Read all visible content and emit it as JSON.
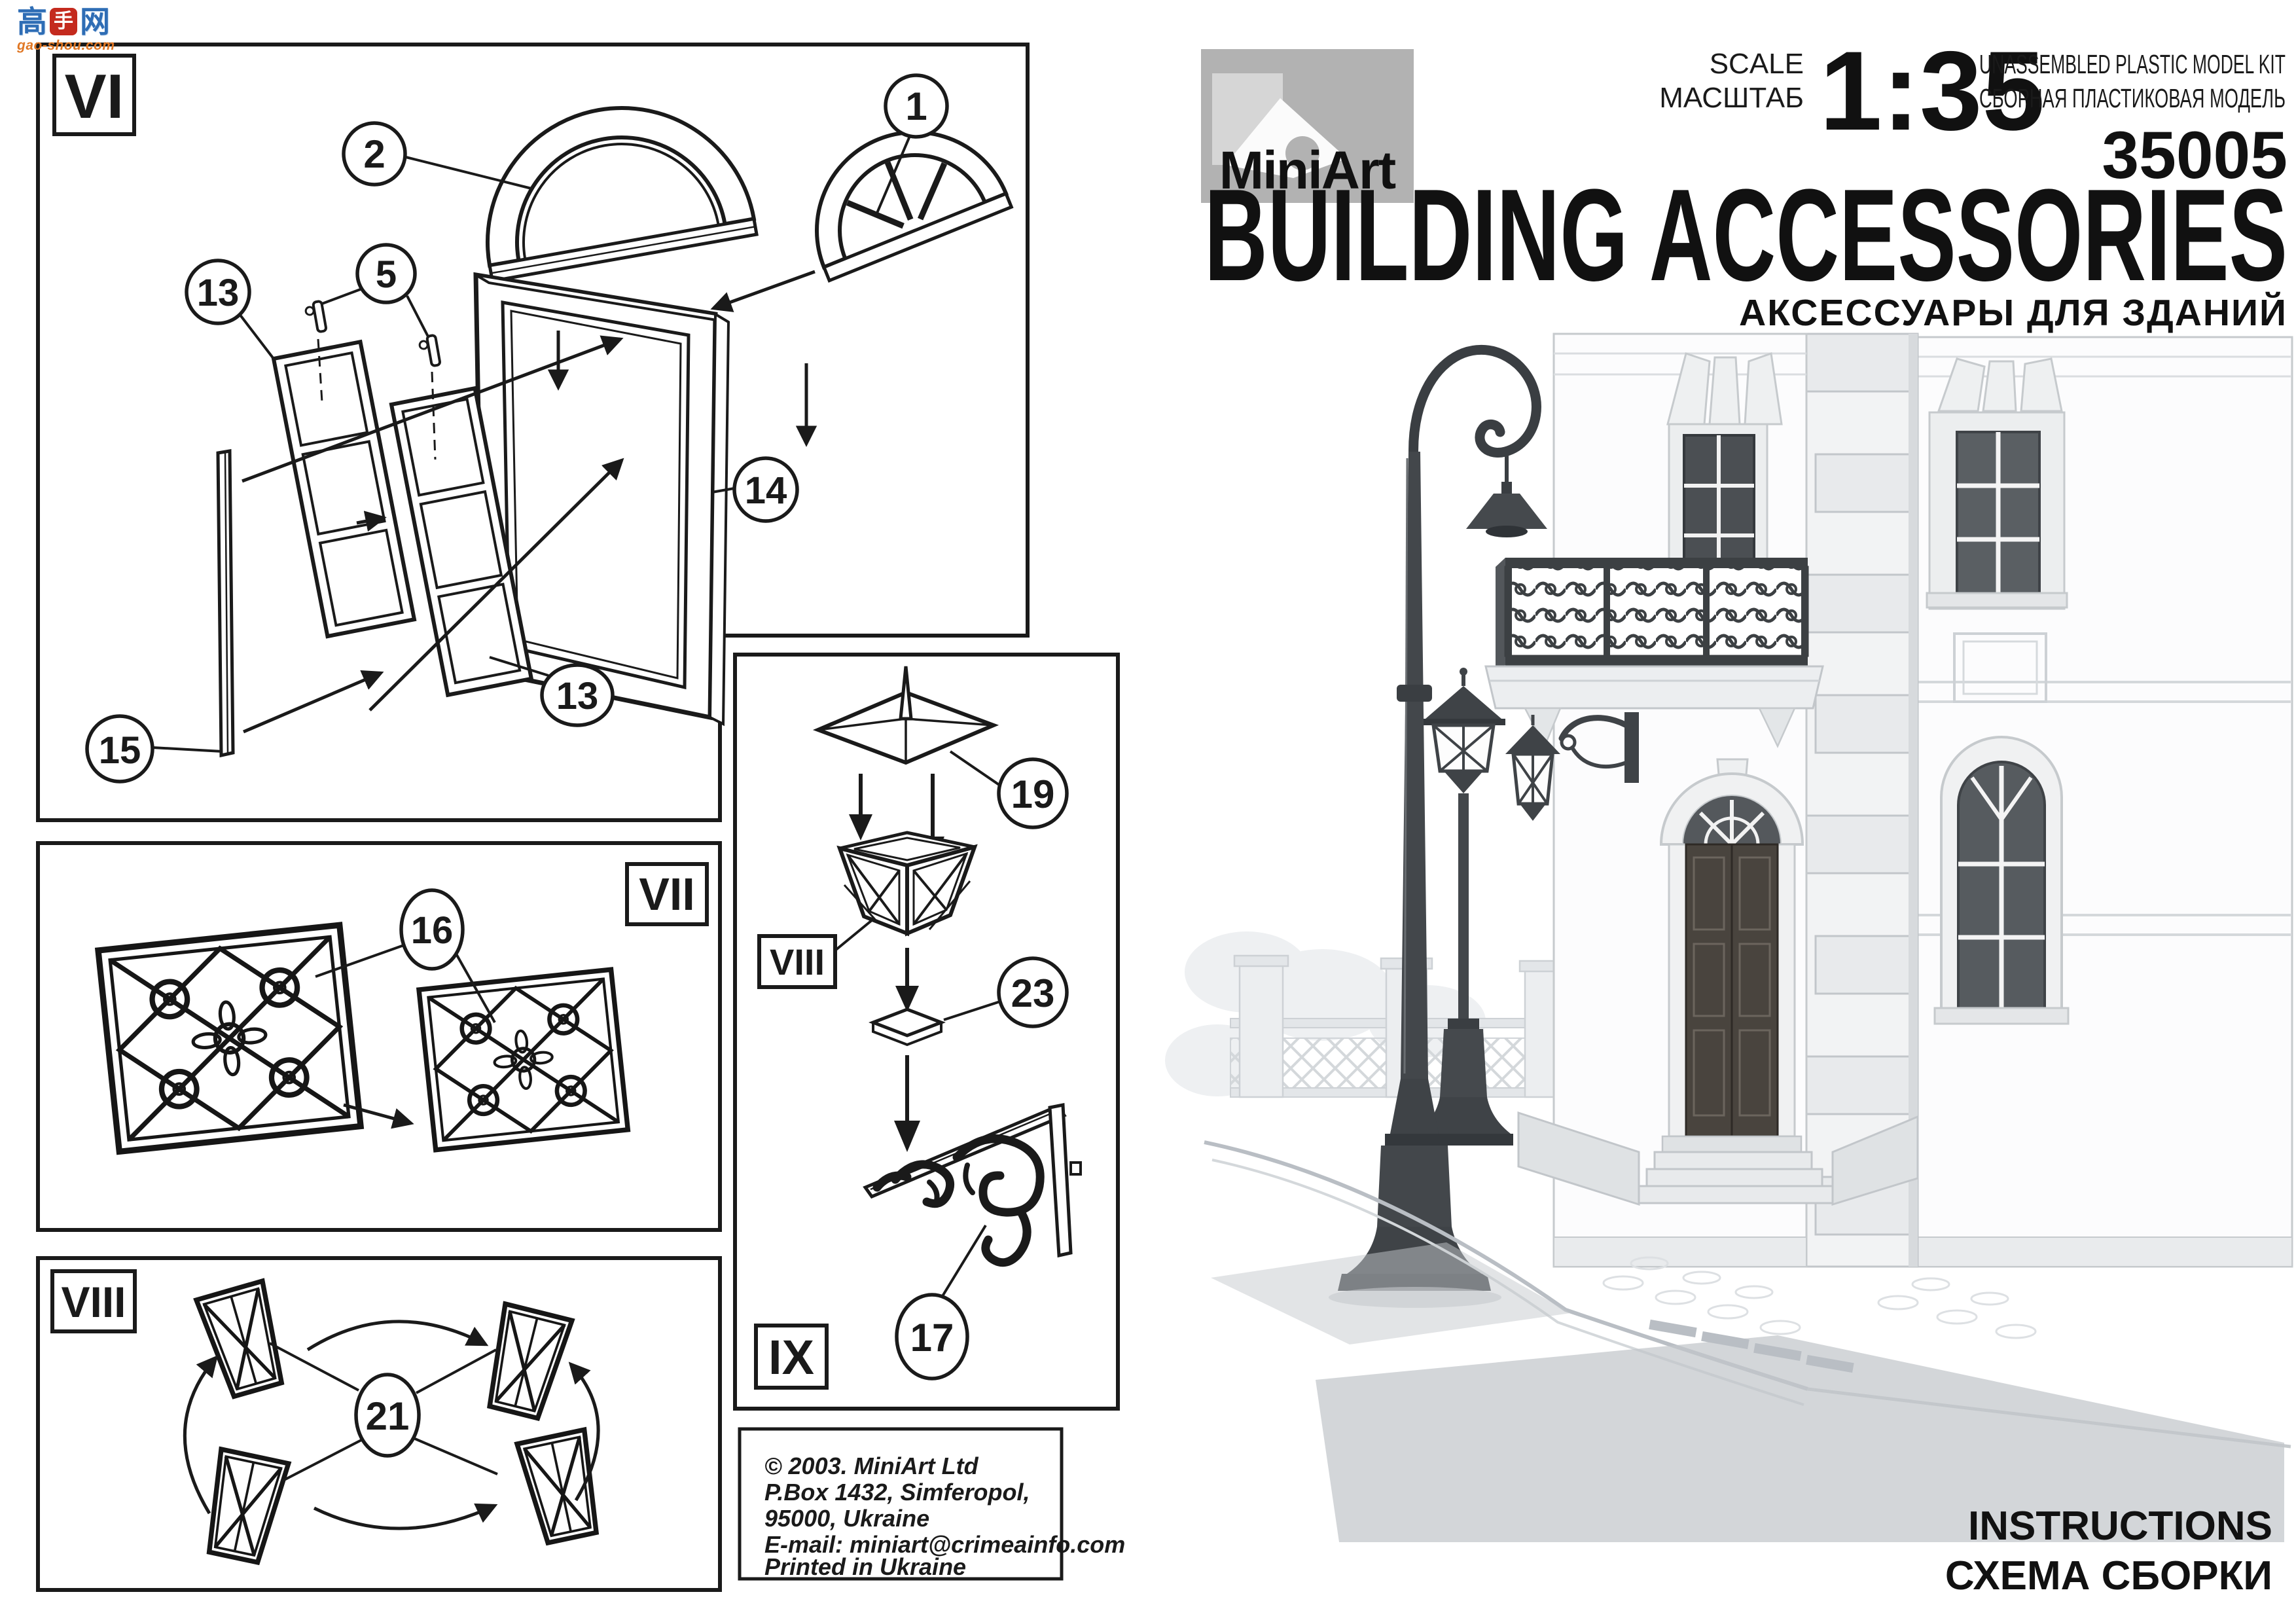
{
  "watermark": {
    "char_left": "高",
    "char_mid": "手",
    "char_right": "网",
    "domain": "gao-shou.com"
  },
  "header": {
    "brand": "MiniArt",
    "scale_label_en": "SCALE",
    "scale_label_ru": "МАСШТАБ",
    "scale_value": "1:35",
    "kit_type_en": "UNASSEMBLED  PLASTIC  MODEL  KIT",
    "kit_type_ru": "СБОРНАЯ  ПЛАСТИКОВАЯ  МОДЕЛЬ",
    "kit_number": "35005",
    "title_en": "BUILDING ACCESSORIES",
    "title_ru": "АКСЕССУАРЫ ДЛЯ ЗДАНИЙ"
  },
  "panels": {
    "vi": "VI",
    "vii": "VII",
    "viii": "VIII",
    "ix": "IX",
    "ix_sub": "VIII"
  },
  "callouts": {
    "c1": "1",
    "c2": "2",
    "c5": "5",
    "c13a": "13",
    "c13b": "13",
    "c14": "14",
    "c15": "15",
    "c16": "16",
    "c17": "17",
    "c19": "19",
    "c21": "21",
    "c23": "23"
  },
  "footer": {
    "copyright": [
      "© 2003. MiniArt Ltd",
      "P.Box 1432, Simferopol,",
      "95000, Ukraine",
      "E-mail: miniart@crimeainfo.com",
      "Printed in Ukraine"
    ],
    "instructions_en": "INSTRUCTIONS",
    "instructions_ru": "СХЕМА СБОРКИ"
  },
  "colors": {
    "ink": "#1a1a1a",
    "paper": "#ffffff",
    "logo_bg": "#b2b2b2",
    "art_light": "#d9dde0",
    "art_mid": "#b9bec4",
    "art_dark": "#43474b",
    "watermark_blue": "#2e6db5",
    "watermark_red": "#c42a1e",
    "watermark_orange": "#e07724"
  }
}
